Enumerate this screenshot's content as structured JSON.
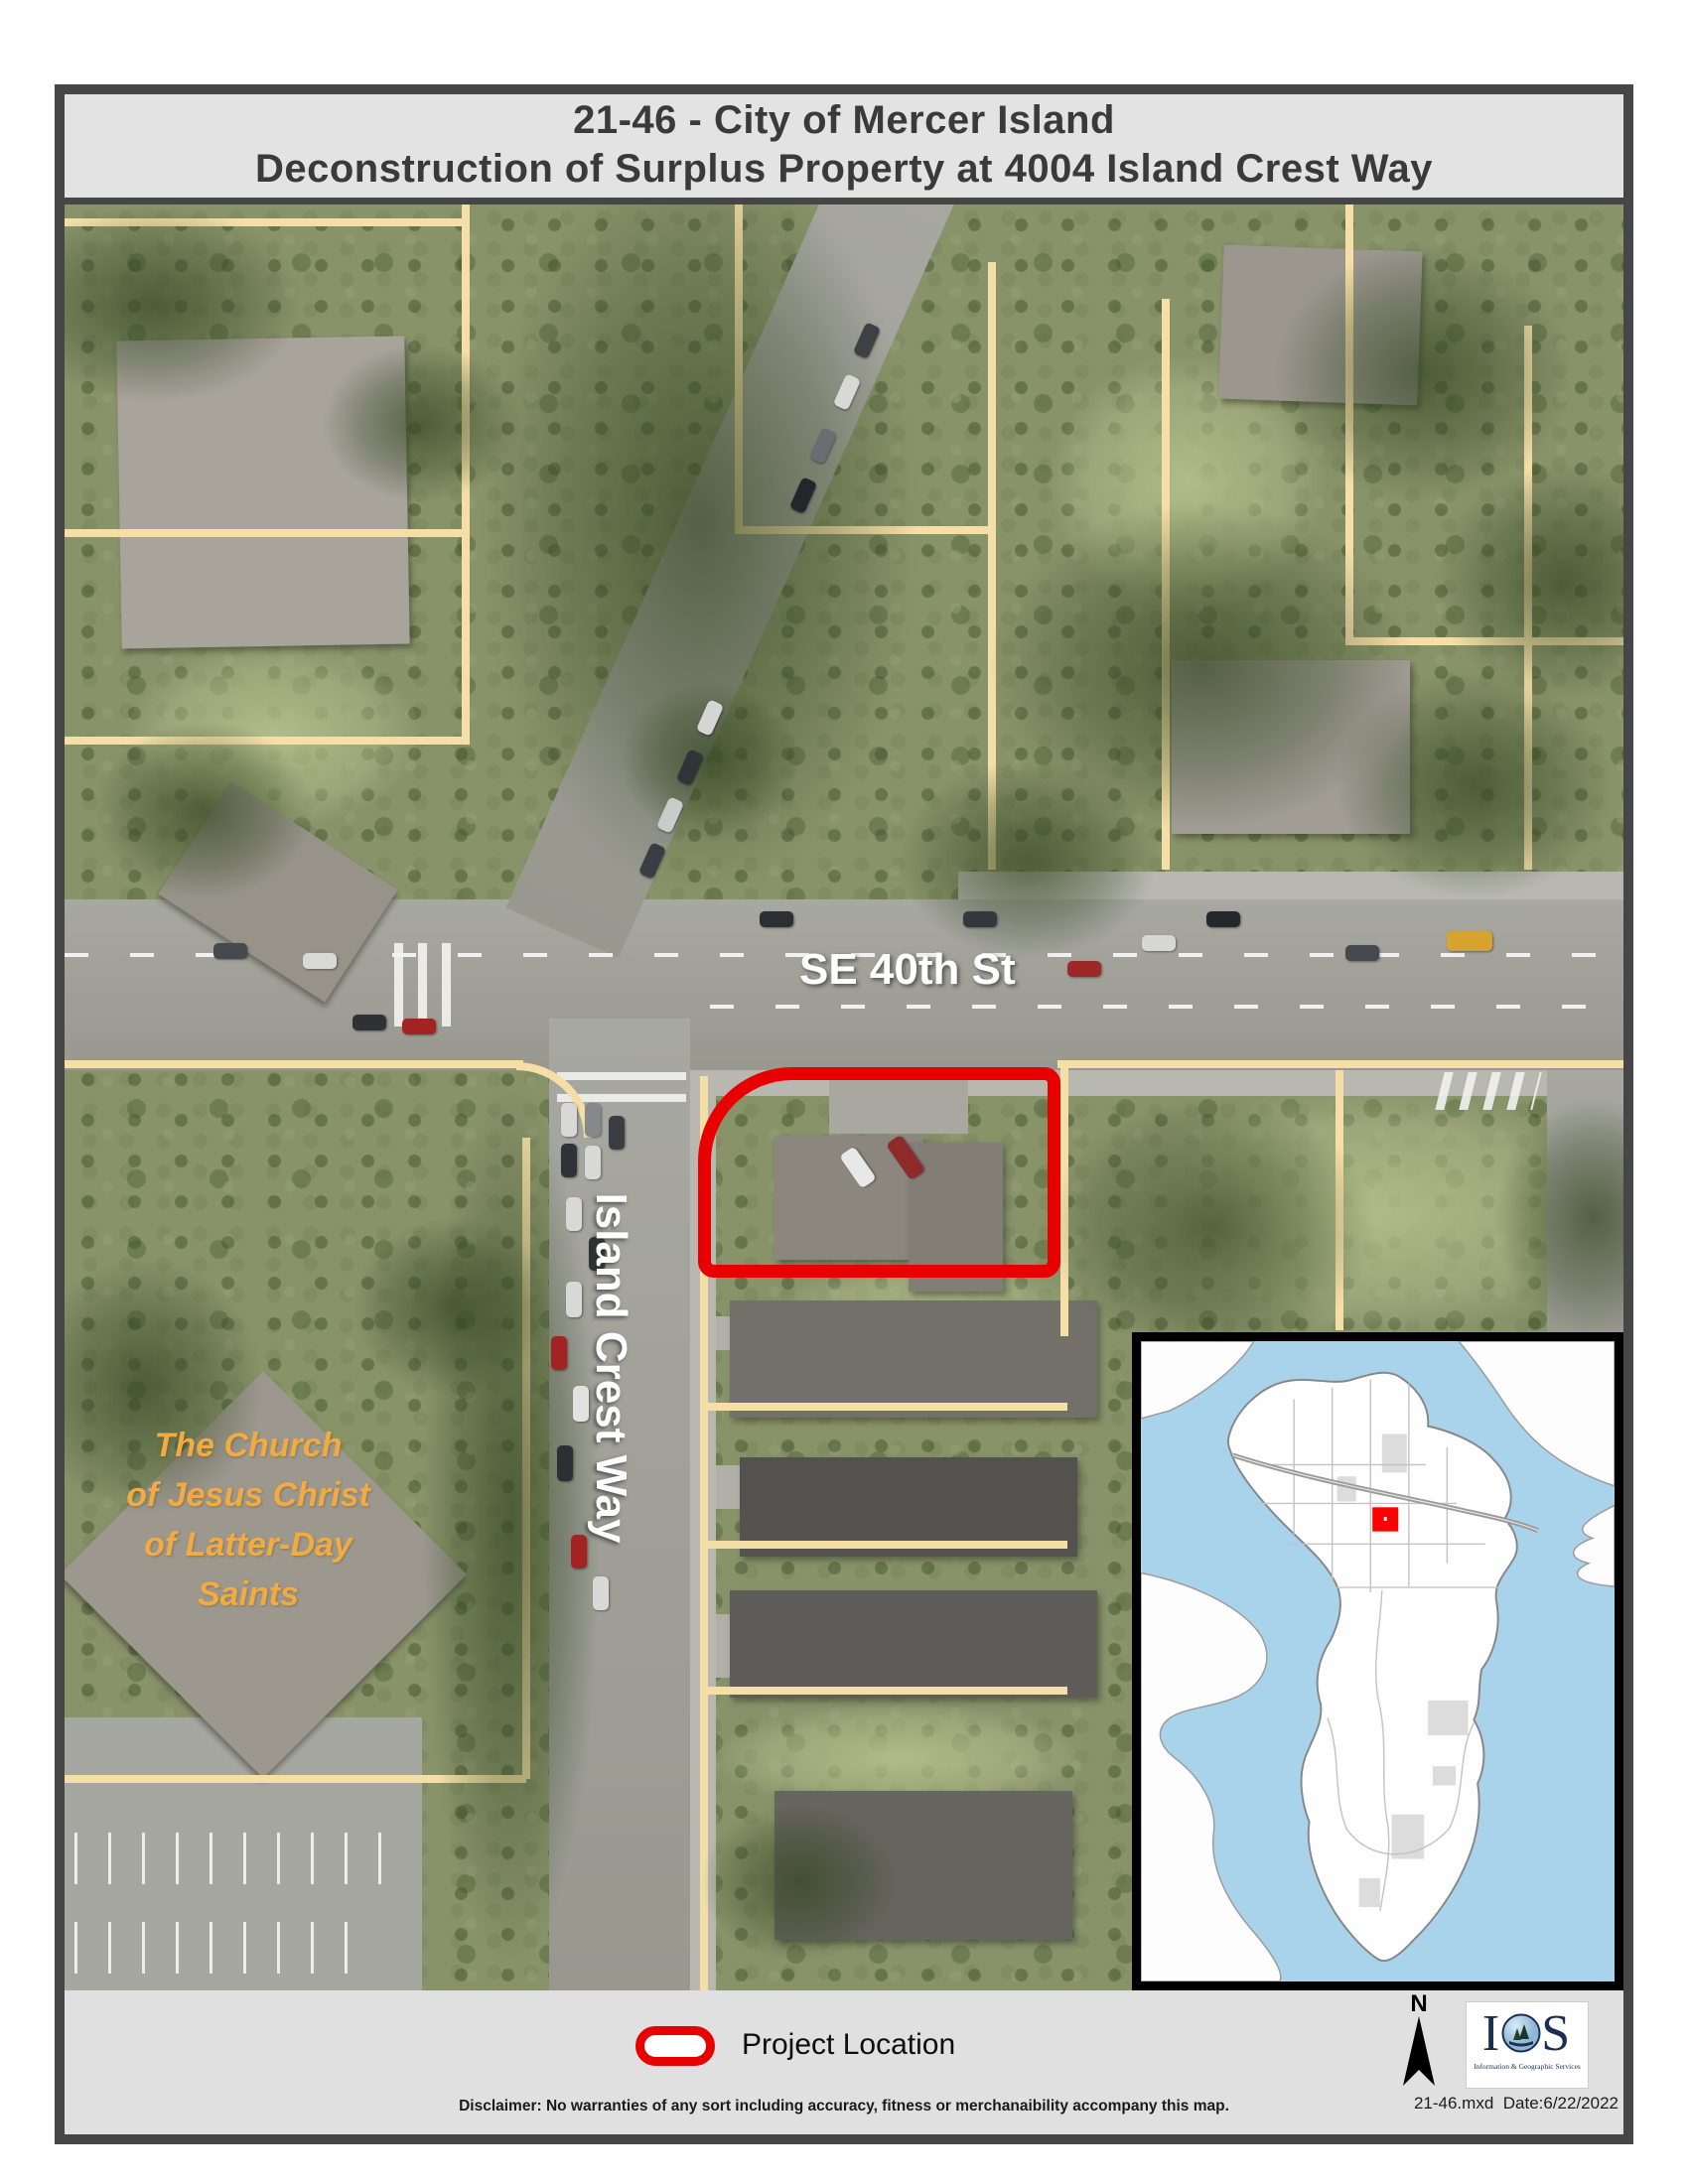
{
  "title": {
    "line1": "21-46 - City of Mercer Island",
    "line2": "Deconstruction of Surplus Property at 4004 Island Crest Way"
  },
  "map": {
    "labels": {
      "street_horizontal": "SE 40th St",
      "street_vertical": "Island Crest Way",
      "church": {
        "line1": "The Church",
        "line2": "of Jesus Christ",
        "line3": "of Latter-Day",
        "line4": "Saints"
      }
    },
    "project_outline_color": "#E80000",
    "parcel_line_color": "#F5DFA7"
  },
  "inset_map": {
    "water_color": "#A9D2EB",
    "land_color": "#FFFFFF",
    "marker_color": "#FF0000"
  },
  "legend": {
    "project_location_label": "Project Location",
    "symbol_color": "#E80000"
  },
  "compass": {
    "north_label": "N"
  },
  "logo": {
    "acronym": "IGS",
    "subtitle": "Information & Geographic Services"
  },
  "footer": {
    "file_name": "21-46.mxd",
    "date_label": "Date:6/22/2022",
    "disclaimer": "Disclaimer: No warranties of any sort including accuracy, fitness or merchanaibility accompany this map."
  }
}
